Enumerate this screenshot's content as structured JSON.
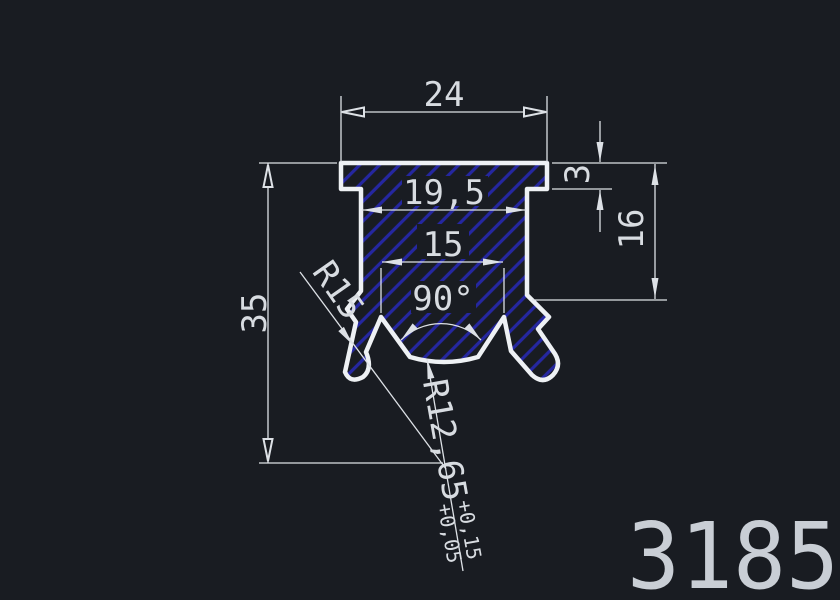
{
  "drawing": {
    "part_number": "3185",
    "dimensions": {
      "flange_width": "24",
      "body_width": "19,5",
      "groove_width": "15",
      "groove_angle": "90°",
      "overall_height": "35",
      "flange_thickness": "3",
      "right_side_height": "16",
      "leg_radius": "R15",
      "bottom_radius": "R12,65",
      "bottom_radius_tol_upper": "+0,15",
      "bottom_radius_tol_lower": "+0,05"
    },
    "colors": {
      "background": "#191c22",
      "outline": "#eef1f4",
      "hatch": "#2527a0",
      "dim_lines": "#dde1e6",
      "dim_text": "#d8dce1",
      "part_number_text": "#c9ced5"
    }
  }
}
